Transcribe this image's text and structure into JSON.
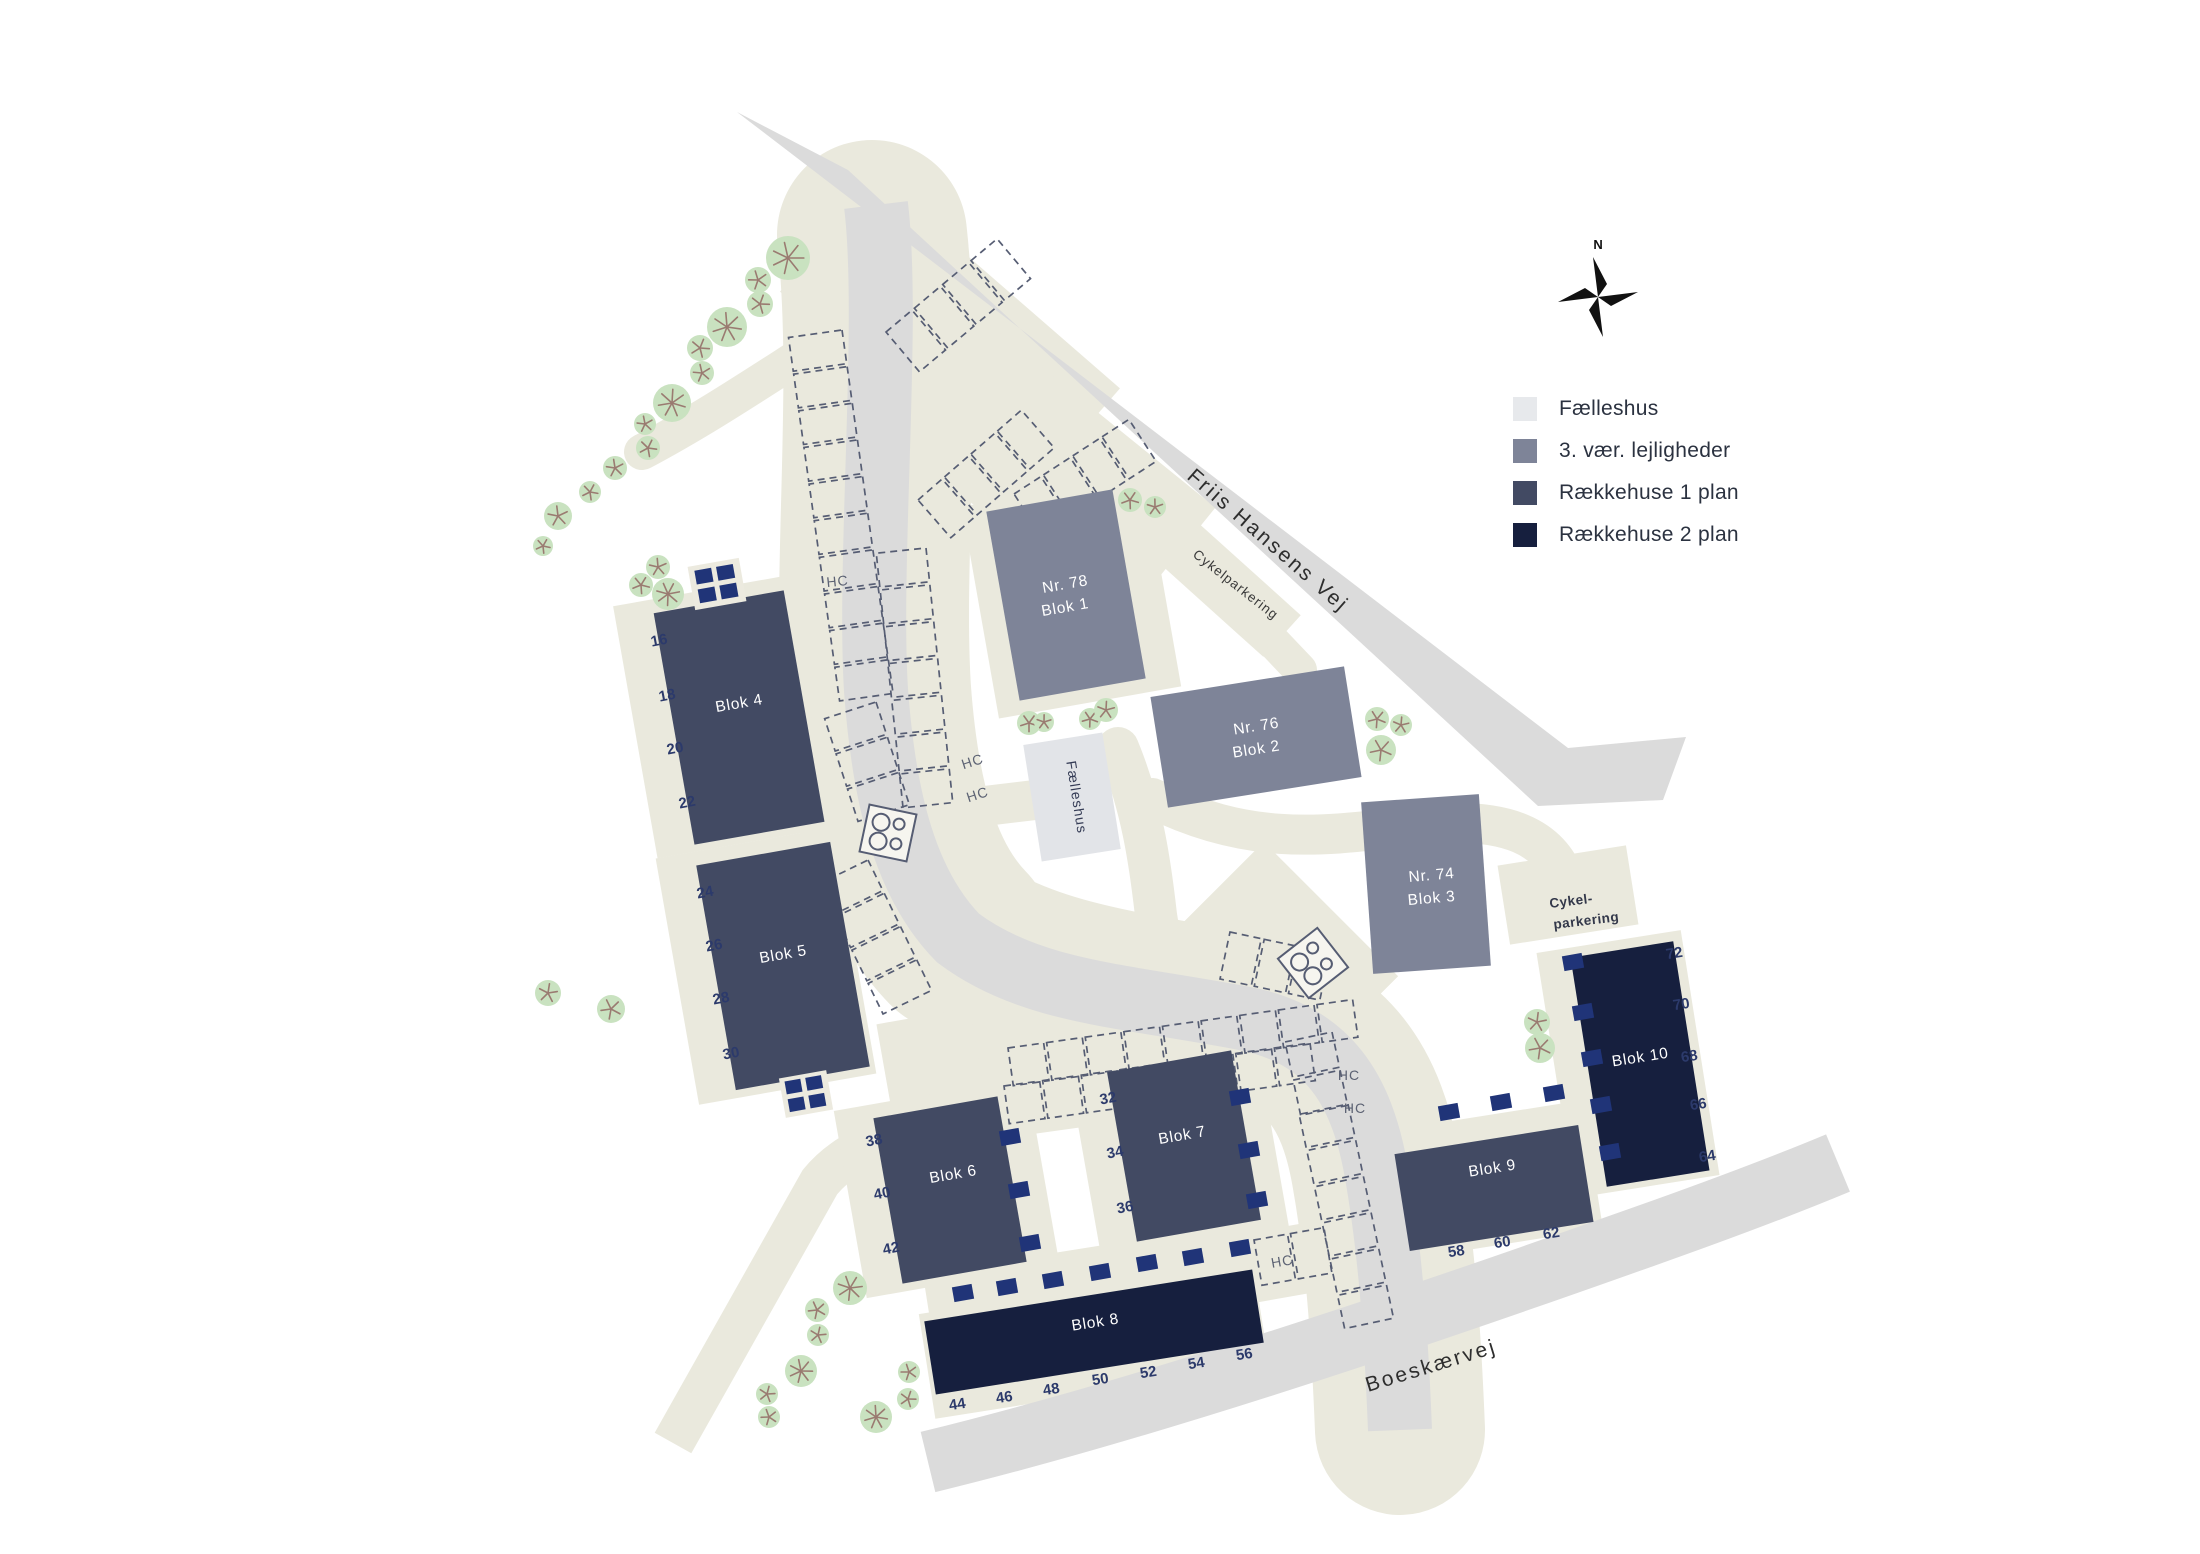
{
  "legend": {
    "items": [
      {
        "label": "Fælleshus",
        "color": "#e7e9ec"
      },
      {
        "label": "3. vær. lejligheder",
        "color": "#7e8498"
      },
      {
        "label": "Rækkehuse 1 plan",
        "color": "#424a63"
      },
      {
        "label": "Rækkehuse 2 plan",
        "color": "#161f3e"
      }
    ]
  },
  "compass": {
    "north_label": "N"
  },
  "streets": {
    "friis_hansens_vej": "Friis Hansens Vej",
    "boeskaervej": "Boeskærvej"
  },
  "labels": {
    "hc": "HC",
    "cykelparkering": "Cykelparkering",
    "cykelparkering_line1": "Cykel-",
    "cykelparkering_line2": "parkering",
    "faelleshus": "Fælleshus"
  },
  "colors": {
    "road": "#dbdbdb",
    "path": "#eae9dd",
    "building_apartments": "#7e8498",
    "building_rowhouse_1": "#424a63",
    "building_rowhouse_2": "#161f3e",
    "building_faelleshus": "#e2e4e8",
    "shed": "#203478",
    "tree": "#c9e2c0"
  },
  "buildings": {
    "blok1": {
      "nr": "Nr. 78",
      "name": "Blok 1"
    },
    "blok2": {
      "nr": "Nr. 76",
      "name": "Blok 2"
    },
    "blok3": {
      "nr": "Nr. 74",
      "name": "Blok 3"
    },
    "blok4": {
      "name": "Blok 4",
      "numbers": [
        "16",
        "18",
        "20",
        "22"
      ]
    },
    "blok5": {
      "name": "Blok 5",
      "numbers": [
        "24",
        "26",
        "28",
        "30"
      ]
    },
    "blok6": {
      "name": "Blok 6",
      "numbers": [
        "38",
        "40",
        "42"
      ]
    },
    "blok7": {
      "name": "Blok 7",
      "numbers": [
        "32",
        "34",
        "36"
      ]
    },
    "blok8": {
      "name": "Blok 8",
      "numbers": [
        "44",
        "46",
        "48",
        "50",
        "52",
        "54",
        "56"
      ]
    },
    "blok9": {
      "name": "Blok 9",
      "numbers": [
        "58",
        "60",
        "62"
      ]
    },
    "blok10": {
      "name": "Blok 10",
      "numbers": [
        "64",
        "66",
        "68",
        "70",
        "72"
      ]
    }
  }
}
